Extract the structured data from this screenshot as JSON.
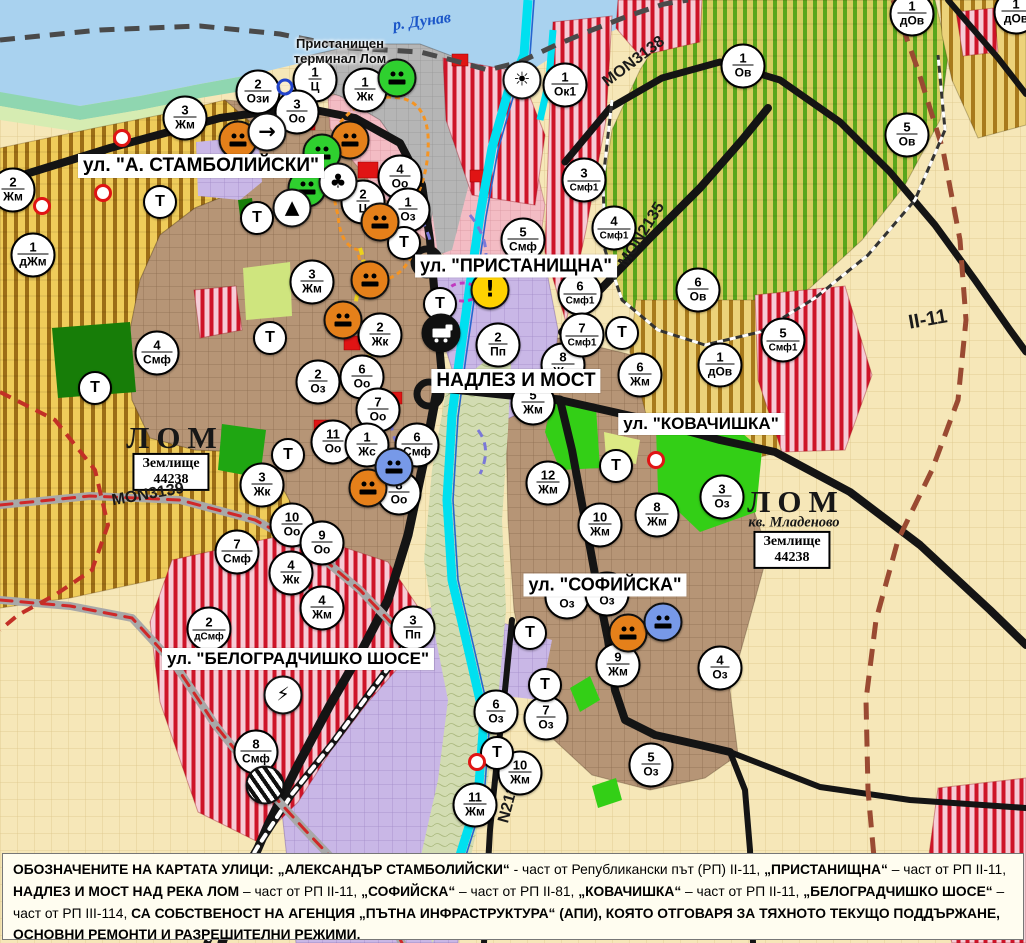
{
  "map": {
    "river_label": {
      "text": "р. Дунав"
    },
    "terminal_label": {
      "line1": "Пристанищен",
      "line2": "терминал Лом"
    },
    "street_labels": [
      {
        "text": "ул. \"А. СТАМБОЛИЙСКИ\"",
        "x": 201,
        "y": 166,
        "fs": 19
      },
      {
        "text": "ул. \"ПРИСТАНИЩНА\"",
        "x": 516,
        "y": 266,
        "fs": 18
      },
      {
        "text": "НАДЛЕЗ И МОСТ",
        "x": 516,
        "y": 381,
        "fs": 19
      },
      {
        "text": "ул. \"КОВАЧИШКА\"",
        "x": 701,
        "y": 424,
        "fs": 17
      },
      {
        "text": "ул. \"СОФИЙСКА\"",
        "x": 605,
        "y": 585,
        "fs": 18
      },
      {
        "text": "ул. \"БЕЛОГРАДЧИШКО ШОСЕ\"",
        "x": 298,
        "y": 659,
        "fs": 17
      }
    ],
    "city_labels": [
      {
        "text": "ЛОМ",
        "x": 175,
        "y": 438
      },
      {
        "text": "ЛОМ",
        "x": 796,
        "y": 502
      }
    ],
    "quarter_label": {
      "text": "кв. Младеново",
      "x": 794,
      "y": 523
    },
    "registry_boxes": [
      {
        "line1": "Землище",
        "line2": "44238",
        "x": 171,
        "y": 472
      },
      {
        "line1": "Землище",
        "line2": "44238",
        "x": 792,
        "y": 550
      }
    ],
    "road_labels": [
      {
        "text": "MON3139",
        "x": 148,
        "y": 495,
        "rot": -10,
        "fs": 16
      },
      {
        "text": "MON3138",
        "x": 634,
        "y": 62,
        "rot": -37,
        "fs": 16
      },
      {
        "text": "MON2135",
        "x": 642,
        "y": 235,
        "rot": -58,
        "fs": 16
      },
      {
        "text": "N2136",
        "x": 510,
        "y": 800,
        "rot": -75,
        "fs": 16
      },
      {
        "text": "II-11",
        "x": 928,
        "y": 320,
        "rot": -10,
        "fs": 20
      }
    ],
    "t_label": "Т",
    "zone_markers": [
      {
        "x": 13,
        "y": 190,
        "num": "2",
        "code": "Жм"
      },
      {
        "x": 185,
        "y": 118,
        "num": "3",
        "code": "Жм"
      },
      {
        "x": 258,
        "y": 92,
        "num": "2",
        "code": "Ози"
      },
      {
        "x": 315,
        "y": 80,
        "num": "1",
        "code": "Ц"
      },
      {
        "x": 297,
        "y": 112,
        "num": "3",
        "code": "Оо"
      },
      {
        "x": 365,
        "y": 90,
        "num": "1",
        "code": "Жк"
      },
      {
        "x": 400,
        "y": 177,
        "num": "4",
        "code": "Оо"
      },
      {
        "x": 363,
        "y": 202,
        "num": "2",
        "code": "Ц"
      },
      {
        "x": 408,
        "y": 210,
        "num": "1",
        "code": "Оз"
      },
      {
        "x": 33,
        "y": 255,
        "num": "1",
        "code": "дЖм"
      },
      {
        "x": 157,
        "y": 353,
        "num": "4",
        "code": "Смф"
      },
      {
        "x": 312,
        "y": 282,
        "num": "3",
        "code": "Жм"
      },
      {
        "x": 380,
        "y": 335,
        "num": "2",
        "code": "Жк"
      },
      {
        "x": 318,
        "y": 382,
        "num": "2",
        "code": "Оз"
      },
      {
        "x": 362,
        "y": 377,
        "num": "6",
        "code": "Оо"
      },
      {
        "x": 378,
        "y": 410,
        "num": "7",
        "code": "Оо"
      },
      {
        "x": 333,
        "y": 442,
        "num": "11",
        "code": "Оо"
      },
      {
        "x": 367,
        "y": 445,
        "num": "1",
        "code": "Жс"
      },
      {
        "x": 417,
        "y": 445,
        "num": "6",
        "code": "Смф"
      },
      {
        "x": 399,
        "y": 493,
        "num": "8",
        "code": "Оо"
      },
      {
        "x": 262,
        "y": 485,
        "num": "3",
        "code": "Жк"
      },
      {
        "x": 292,
        "y": 525,
        "num": "10",
        "code": "Оо"
      },
      {
        "x": 322,
        "y": 543,
        "num": "9",
        "code": "Оо"
      },
      {
        "x": 237,
        "y": 552,
        "num": "7",
        "code": "Смф"
      },
      {
        "x": 291,
        "y": 573,
        "num": "4",
        "code": "Жк"
      },
      {
        "x": 322,
        "y": 608,
        "num": "4",
        "code": "Жм"
      },
      {
        "x": 209,
        "y": 629,
        "num": "2",
        "code": "дСмф"
      },
      {
        "x": 413,
        "y": 628,
        "num": "3",
        "code": "Пп"
      },
      {
        "x": 256,
        "y": 752,
        "num": "8",
        "code": "Смф"
      },
      {
        "x": 523,
        "y": 240,
        "num": "5",
        "code": "Смф"
      },
      {
        "x": 498,
        "y": 345,
        "num": "2",
        "code": "Пп"
      },
      {
        "x": 563,
        "y": 365,
        "num": "8",
        "code": "Жм"
      },
      {
        "x": 533,
        "y": 403,
        "num": "5",
        "code": "Жм"
      },
      {
        "x": 640,
        "y": 375,
        "num": "6",
        "code": "Жм"
      },
      {
        "x": 548,
        "y": 483,
        "num": "12",
        "code": "Жм"
      },
      {
        "x": 600,
        "y": 525,
        "num": "10",
        "code": "Жм"
      },
      {
        "x": 657,
        "y": 515,
        "num": "8",
        "code": "Жм"
      },
      {
        "x": 722,
        "y": 497,
        "num": "3",
        "code": "Оз"
      },
      {
        "x": 618,
        "y": 665,
        "num": "9",
        "code": "Жм"
      },
      {
        "x": 720,
        "y": 668,
        "num": "4",
        "code": "Оз"
      },
      {
        "x": 496,
        "y": 712,
        "num": "6",
        "code": "Оз"
      },
      {
        "x": 546,
        "y": 718,
        "num": "7",
        "code": "Оз"
      },
      {
        "x": 651,
        "y": 765,
        "num": "5",
        "code": "Оз"
      },
      {
        "x": 520,
        "y": 773,
        "num": "10",
        "code": "Жм"
      },
      {
        "x": 475,
        "y": 805,
        "num": "11",
        "code": "Жм"
      },
      {
        "x": 565,
        "y": 85,
        "num": "1",
        "code": "Ок1"
      },
      {
        "x": 584,
        "y": 180,
        "num": "3",
        "code": "Смф1"
      },
      {
        "x": 614,
        "y": 228,
        "num": "4",
        "code": "Смф1"
      },
      {
        "x": 580,
        "y": 293,
        "num": "6",
        "code": "Смф1"
      },
      {
        "x": 582,
        "y": 335,
        "num": "7",
        "code": "Смф1"
      },
      {
        "x": 743,
        "y": 66,
        "num": "1",
        "code": "Ов"
      },
      {
        "x": 907,
        "y": 135,
        "num": "5",
        "code": "Ов"
      },
      {
        "x": 698,
        "y": 290,
        "num": "6",
        "code": "Ов"
      },
      {
        "x": 720,
        "y": 365,
        "num": "1",
        "code": "дОв"
      },
      {
        "x": 783,
        "y": 340,
        "num": "5",
        "code": "Смф1"
      },
      {
        "x": 912,
        "y": 14,
        "num": "1",
        "code": "дОв"
      },
      {
        "x": 1016,
        "y": 12,
        "num": "1",
        "code": "дОв"
      },
      {
        "x": 567,
        "y": 597,
        "num": "",
        "code": "Оз"
      },
      {
        "x": 607,
        "y": 594,
        "num": "",
        "code": "Оз"
      }
    ],
    "t_markers": [
      {
        "x": 160,
        "y": 202
      },
      {
        "x": 257,
        "y": 218
      },
      {
        "x": 270,
        "y": 338
      },
      {
        "x": 288,
        "y": 455
      },
      {
        "x": 95,
        "y": 388
      },
      {
        "x": 404,
        "y": 243
      },
      {
        "x": 440,
        "y": 304
      },
      {
        "x": 622,
        "y": 333
      },
      {
        "x": 616,
        "y": 466
      },
      {
        "x": 530,
        "y": 633
      },
      {
        "x": 545,
        "y": 685
      },
      {
        "x": 497,
        "y": 753
      }
    ],
    "icon_markers": [
      {
        "x": 238,
        "y": 140,
        "type": "monument-orange"
      },
      {
        "x": 350,
        "y": 140,
        "type": "monument-orange"
      },
      {
        "x": 380,
        "y": 222,
        "type": "monument-orange"
      },
      {
        "x": 370,
        "y": 280,
        "type": "monument-orange"
      },
      {
        "x": 343,
        "y": 320,
        "type": "monument-orange"
      },
      {
        "x": 368,
        "y": 488,
        "type": "monument-orange"
      },
      {
        "x": 628,
        "y": 633,
        "type": "monument-orange"
      },
      {
        "x": 397,
        "y": 78,
        "type": "monument-green"
      },
      {
        "x": 322,
        "y": 153,
        "type": "monument-green"
      },
      {
        "x": 307,
        "y": 188,
        "type": "monument-green"
      },
      {
        "x": 394,
        "y": 467,
        "type": "monument-blue"
      },
      {
        "x": 663,
        "y": 622,
        "type": "monument-blue"
      },
      {
        "x": 267,
        "y": 132,
        "type": "arrow-sign"
      },
      {
        "x": 338,
        "y": 182,
        "type": "club-sign"
      },
      {
        "x": 292,
        "y": 208,
        "type": "pyramid-sign"
      },
      {
        "x": 522,
        "y": 80,
        "type": "fan-sign"
      },
      {
        "x": 490,
        "y": 290,
        "type": "warning"
      },
      {
        "x": 441,
        "y": 333,
        "type": "truck-sign"
      },
      {
        "x": 283,
        "y": 695,
        "type": "lightning-sign"
      },
      {
        "x": 265,
        "y": 785,
        "type": "rail-crossing"
      }
    ],
    "icon_glyphs": {
      "arrow-sign": "→",
      "club-sign": "♣",
      "pyramid-sign": "▲",
      "fan-sign": "☀",
      "warning": "!",
      "lightning-sign": "⚡",
      "monument-orange": "",
      "monument-green": "",
      "monument-blue": "",
      "truck-sign": "",
      "rail-crossing": ""
    },
    "icon_colors": {
      "monument-orange": "#e5801a",
      "monument-green": "#2fd02f",
      "monument-blue": "#7799e8",
      "arrow-sign": "#ffffff",
      "club-sign": "#ffffff",
      "pyramid-sign": "#ffffff",
      "fan-sign": "#ffffff",
      "warning": "#ffd200",
      "truck-sign": "#101010",
      "lightning-sign": "#ffffff",
      "rail-crossing": "#ffffff"
    },
    "dots": [
      {
        "x": 122,
        "y": 138,
        "cls": "red"
      },
      {
        "x": 103,
        "y": 193,
        "cls": "red"
      },
      {
        "x": 42,
        "y": 206,
        "cls": "red"
      },
      {
        "x": 656,
        "y": 460,
        "cls": "red"
      },
      {
        "x": 477,
        "y": 762,
        "cls": "red"
      },
      {
        "x": 285,
        "y": 87,
        "cls": "blue"
      }
    ],
    "zone_colors": {
      "residential_brown": "#b69576",
      "mixed_smf_stripe": "#ce1428",
      "vineyard_ov": "#59a61c",
      "agri_yellow": "#efcc5a",
      "industrial_purple": "#c9b7e6",
      "park_green": "#33cf16",
      "river_cyan": "#00e0f0",
      "danube_blue": "#a9d2ef",
      "road_black": "#141414"
    }
  },
  "caption": {
    "segments": [
      {
        "t": "ОБОЗНАЧЕНИТЕ НА КАРТАТА УЛИЦИ: „АЛЕКСАНДЪР СТАМБОЛИЙСКИ“",
        "b": true
      },
      {
        "t": " - част от Републикански път (РП) II-11, ",
        "b": false
      },
      {
        "t": "„ПРИСТАНИЩНА“",
        "b": true
      },
      {
        "t": " – част от РП II-11, ",
        "b": false
      },
      {
        "t": "НАДЛЕЗ И МОСТ НАД РЕКА ЛОМ",
        "b": true
      },
      {
        "t": " – част от РП II-11, ",
        "b": false
      },
      {
        "t": "„СОФИЙСКА“",
        "b": true
      },
      {
        "t": " – част от РП II-81, ",
        "b": false
      },
      {
        "t": "„КОВАЧИШКА“",
        "b": true
      },
      {
        "t": " – част от РП II-11, ",
        "b": false
      },
      {
        "t": "„БЕЛОГРАДЧИШКО ШОСЕ“",
        "b": true
      },
      {
        "t": " – част от РП III-114, ",
        "b": false
      },
      {
        "t": "СА СОБСТВЕНОСТ НА АГЕНЦИЯ „ПЪТНА ИНФРАСТРУКТУРА“ (АПИ), КОЯТО ОТГОВАРЯ ЗА ТЯХНОТО ТЕКУЩО ПОДДЪРЖАНЕ, ОСНОВНИ РЕМОНТИ И РАЗРЕШИТЕЛНИ РЕЖИМИ.",
        "b": true
      }
    ]
  }
}
